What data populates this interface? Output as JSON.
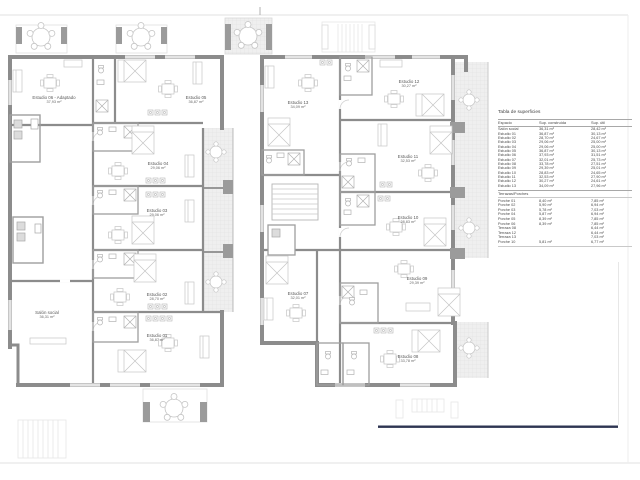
{
  "areas_table": {
    "title": "Tabla de superficies",
    "columns": {
      "space": "Espacio",
      "built": "Sup. construida",
      "useful": "Sup. útil"
    },
    "spaces": [
      {
        "name": "Salón social",
        "built": "36,31 m²",
        "useful": "28,42 m²"
      },
      {
        "name": "Estudio 01",
        "built": "36,87 m²",
        "useful": "30,13 m²"
      },
      {
        "name": "Estudio 02",
        "built": "28,70 m²",
        "useful": "24,67 m²"
      },
      {
        "name": "Estudio 03",
        "built": "29,06 m²",
        "useful": "25,00 m²"
      },
      {
        "name": "Estudio 04",
        "built": "29,06 m²",
        "useful": "25,00 m²"
      },
      {
        "name": "Estudio 05",
        "built": "36,87 m²",
        "useful": "30,13 m²"
      },
      {
        "name": "Estudio 06",
        "built": "37,93 m²",
        "useful": "31,51 m²"
      },
      {
        "name": "Estudio 07",
        "built": "32,01 m²",
        "useful": "25,73 m²"
      },
      {
        "name": "Estudio 08",
        "built": "33,78 m²",
        "useful": "27,51 m²"
      },
      {
        "name": "Estudio 09",
        "built": "29,39 m²",
        "useful": "25,01 m²"
      },
      {
        "name": "Estudio 10",
        "built": "28,83 m²",
        "useful": "24,65 m²"
      },
      {
        "name": "Estudio 11",
        "built": "32,53 m²",
        "useful": "27,90 m²"
      },
      {
        "name": "Estudio 12",
        "built": "30,27 m²",
        "useful": "24,61 m²"
      },
      {
        "name": "Estudio 13",
        "built": "34,09 m²",
        "useful": "27,96 m²"
      }
    ],
    "terraces_title": "Terrazas/Porches",
    "terraces": [
      {
        "name": "Porche 01",
        "built": "8,40 m²",
        "useful": "7,85 m²"
      },
      {
        "name": "Porche 02",
        "built": "5,90 m²",
        "useful": "6,94 m²"
      },
      {
        "name": "Porche 03",
        "built": "5,78 m²",
        "useful": "7,03 m²"
      },
      {
        "name": "Porche 04",
        "built": "5,87 m²",
        "useful": "6,94 m²"
      },
      {
        "name": "Porche 05",
        "built": "8,39 m²",
        "useful": "7,85 m²"
      },
      {
        "name": "Porche 06",
        "built": "8,39 m²",
        "useful": "7,85 m²"
      },
      {
        "name": "Terraza 08",
        "built": "",
        "useful": "6,44 m²"
      },
      {
        "name": "Terraza 12",
        "built": "",
        "useful": "6,44 m²"
      },
      {
        "name": "Terraza 13",
        "built": "",
        "useful": "7,03 m²"
      },
      {
        "name": "Porche 10",
        "built": "5,81 m²",
        "useful": "6,77 m²"
      }
    ]
  },
  "plan": {
    "rooms": [
      {
        "name": "Estudio 06 - Adaptado",
        "area": "37,93 m²"
      },
      {
        "name": "Estudio 05",
        "area": "36,87 m²"
      },
      {
        "name": "Estudio 04",
        "area": "29,06 m²"
      },
      {
        "name": "Estudio 03",
        "area": "29,06 m²"
      },
      {
        "name": "Estudio 02",
        "area": "28,70 m²"
      },
      {
        "name": "Estudio 01",
        "area": "36,87 m²"
      },
      {
        "name": "Salón social",
        "area": "36,31 m²"
      },
      {
        "name": "Estudio 13",
        "area": "34,09 m²"
      },
      {
        "name": "Estudio 12",
        "area": "30,27 m²"
      },
      {
        "name": "Estudio 11",
        "area": "32,53 m²"
      },
      {
        "name": "Estudio 10",
        "area": "28,83 m²"
      },
      {
        "name": "Estudio 09",
        "area": "29,39 m²"
      },
      {
        "name": "Estudio 07",
        "area": "32,01 m²"
      },
      {
        "name": "Estudio 08",
        "area": "33,78 m²"
      }
    ]
  },
  "colors": {
    "wall_gray": "#8c8c8c",
    "furniture_gray": "#c9c9c9",
    "terrace_hatch": "#efefef",
    "navy_line": "#2e3552"
  }
}
